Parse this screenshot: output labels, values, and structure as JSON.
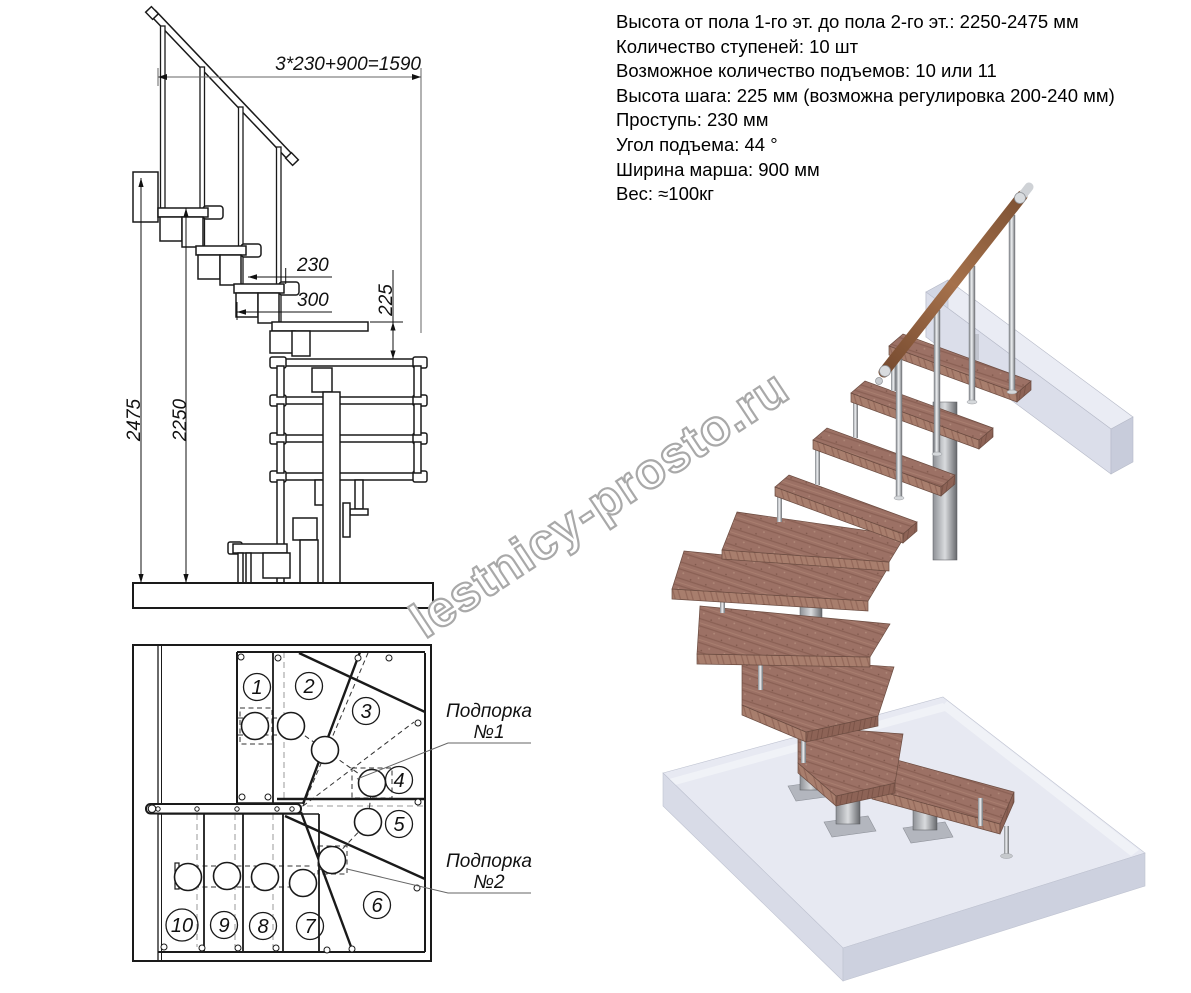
{
  "specs": {
    "lines": [
      "Высота от пола 1-го эт. до пола 2-го эт.: 2250-2475 мм",
      "Количество ступеней: 10 шт",
      "Возможное количество подъемов: 10 или 11",
      "Высота шага: 225 мм (возможна регулировка 200-240 мм)",
      "Проступь: 230 мм",
      "Угол подъема: 44 °",
      "Ширина марша: 900 мм",
      "Вес: ≈100кг"
    ]
  },
  "elevation": {
    "dim_top": "3*230+900=1590",
    "dim_tread": "230",
    "dim_module": "300",
    "dim_rise": "225",
    "dim_height_max": "2475",
    "dim_height_min": "2250"
  },
  "plan": {
    "step_numbers": [
      "1",
      "2",
      "3",
      "4",
      "5",
      "6",
      "7",
      "8",
      "9",
      "10"
    ],
    "support1": {
      "line1": "Подпорка",
      "line2": "№1"
    },
    "support2": {
      "line1": "Подпорка",
      "line2": "№2"
    }
  },
  "watermark": "lestnicy-prosto.ru",
  "colors": {
    "drawing_line": "#1a1a1a",
    "wood": "#9c7165",
    "wood_light": "#a87e6d",
    "metal": "#b9bcc0",
    "floor": "#e7e9f2",
    "handrail_wood": "#8a5a3a",
    "watermark_outline": "#a9a9a9"
  }
}
